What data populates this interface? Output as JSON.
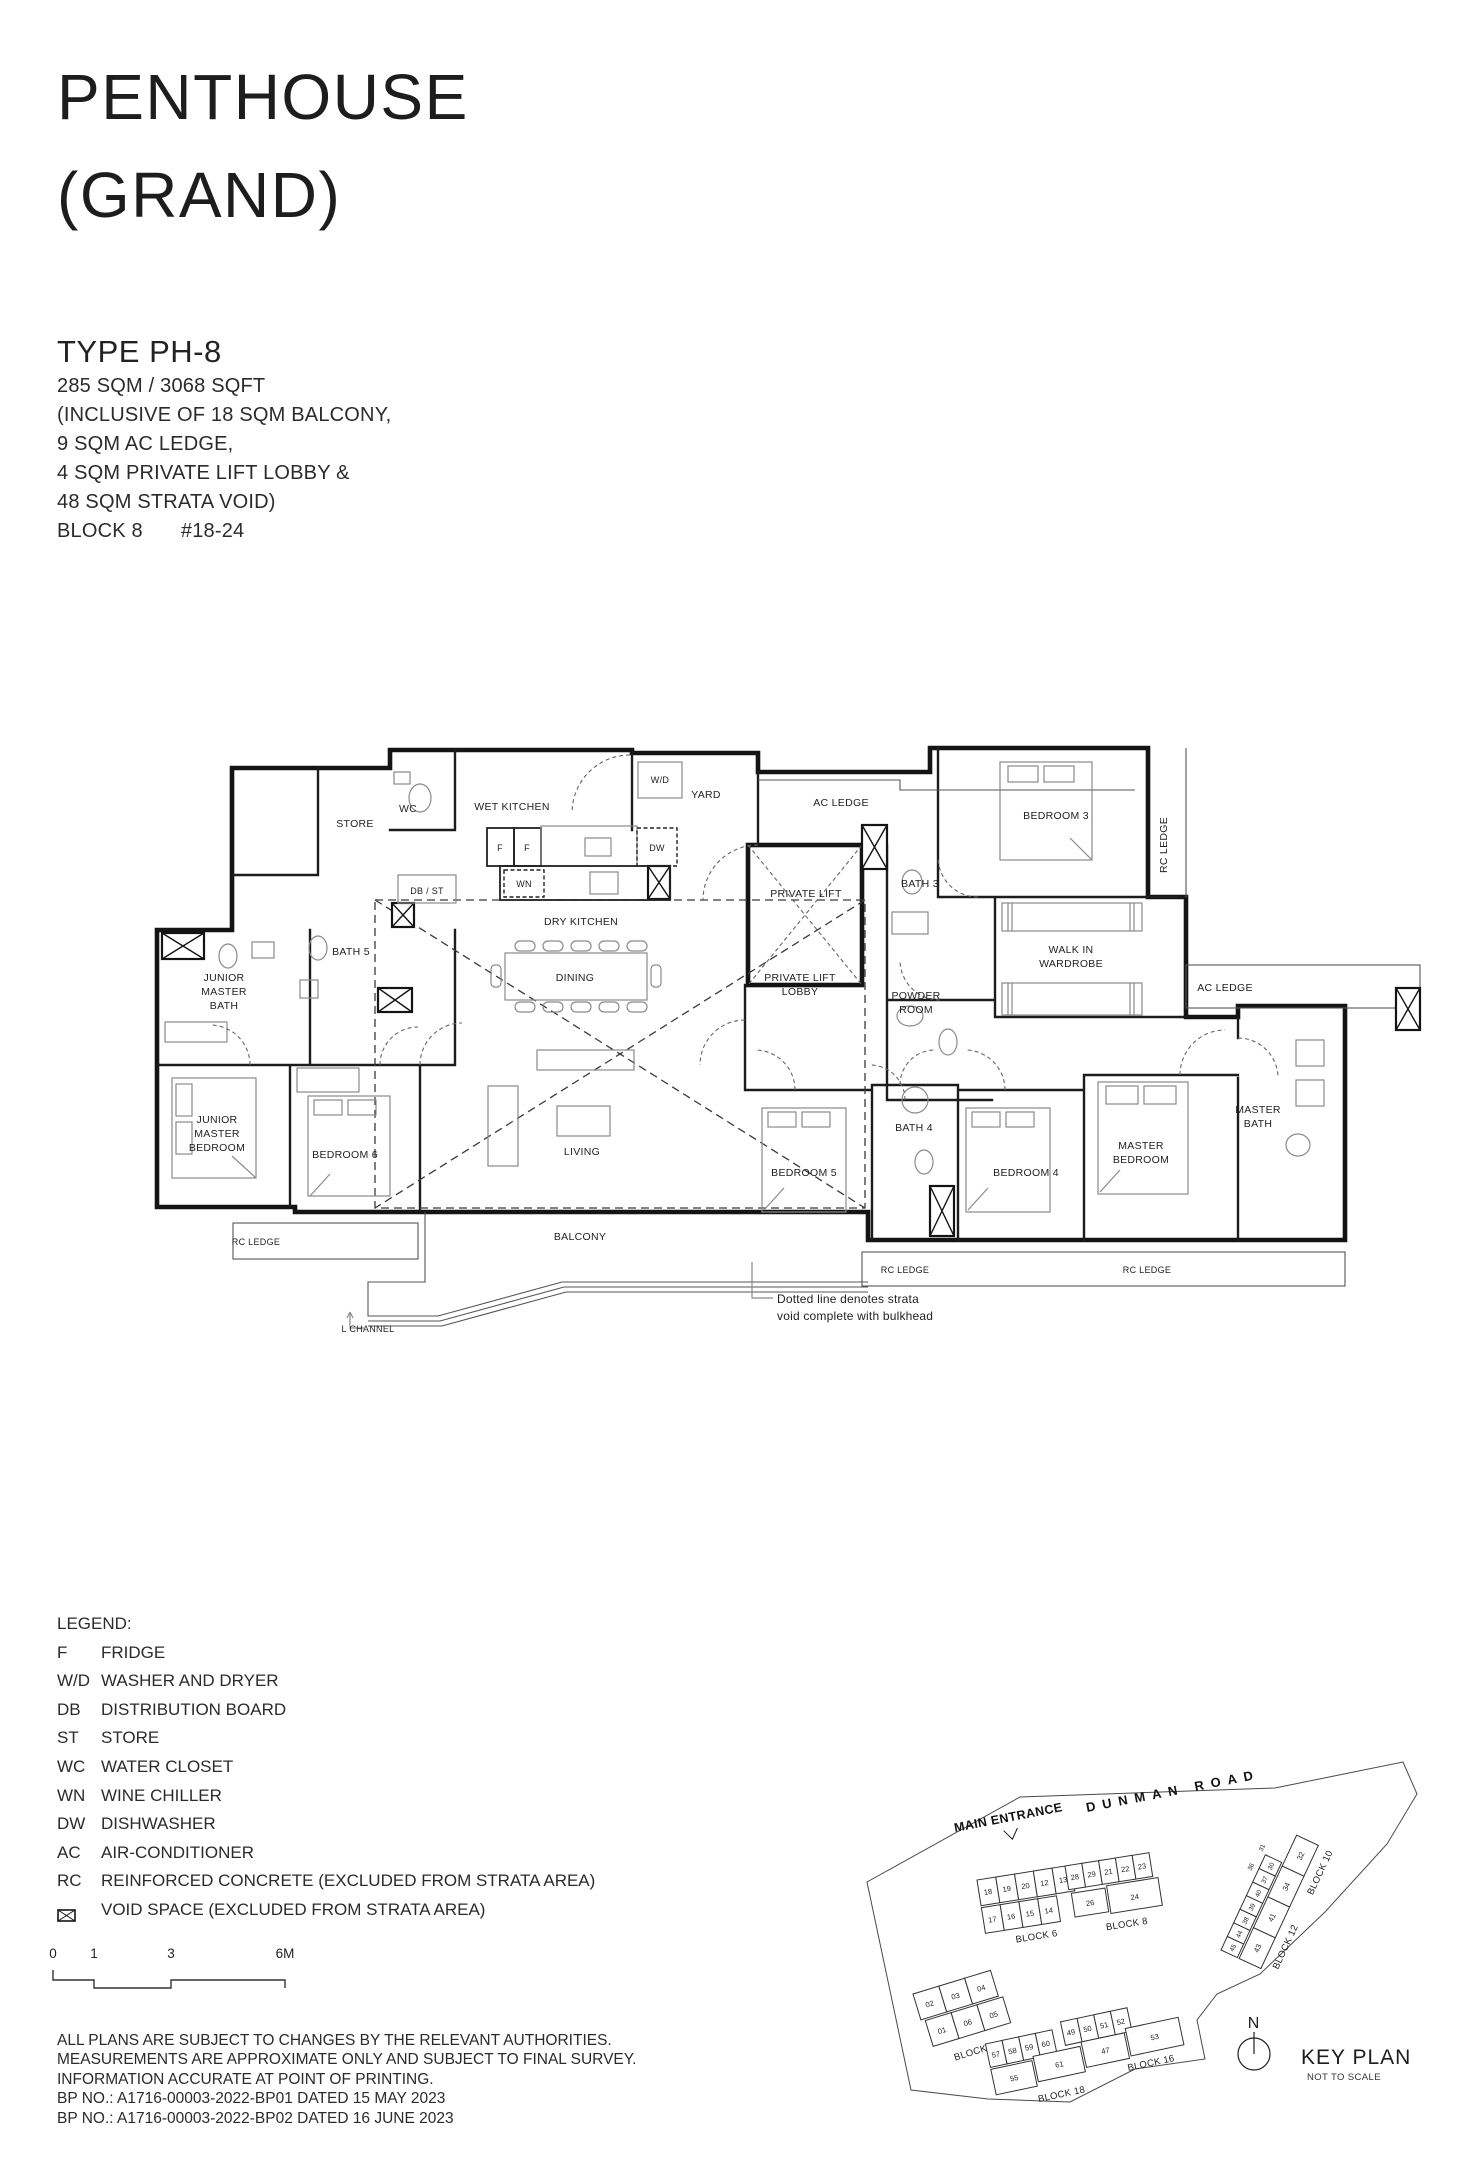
{
  "page": {
    "title_line1": "PENTHOUSE",
    "title_line2": "(GRAND)"
  },
  "unit_info": {
    "type_label": "TYPE PH-8",
    "area": "285 SQM / 3068 SQFT",
    "inclusions": [
      "(INCLUSIVE OF 18 SQM BALCONY,",
      "9 SQM AC LEDGE,",
      "4 SQM PRIVATE LIFT LOBBY &",
      "48 SQM STRATA VOID)"
    ],
    "block": "BLOCK 8",
    "unit": "#18-24"
  },
  "floor_plan": {
    "labels": [
      "STORE",
      "WC",
      "WET KITCHEN",
      "W/D",
      "YARD",
      "AC LEDGE",
      "BEDROOM 3",
      "RC LEDGE",
      "BATH 3",
      "WALK IN",
      "WARDROBE",
      "AC LEDGE",
      "DB / ST",
      "F",
      "F",
      "DW",
      "WN",
      "DRY KITCHEN",
      "PRIVATE LIFT",
      "PRIVATE LIFT",
      "LOBBY",
      "POWDER",
      "ROOM",
      "BATH 5",
      "JUNIOR",
      "MASTER",
      "BATH",
      "JUNIOR",
      "MASTER",
      "BEDROOM",
      "BEDROOM 6",
      "DINING",
      "LIVING",
      "BEDROOM 5",
      "BATH 4",
      "BEDROOM 4",
      "MASTER",
      "BEDROOM",
      "MASTER",
      "BATH",
      "BALCONY",
      "RC LEDGE",
      "RC LEDGE",
      "RC LEDGE",
      "L CHANNEL",
      "Dotted line denotes strata",
      "void complete with bulkhead"
    ]
  },
  "legend": {
    "heading": "LEGEND:",
    "items": [
      {
        "key": "F",
        "value": "FRIDGE"
      },
      {
        "key": "W/D",
        "value": "WASHER AND DRYER"
      },
      {
        "key": "DB",
        "value": "DISTRIBUTION BOARD"
      },
      {
        "key": "ST",
        "value": "STORE"
      },
      {
        "key": "WC",
        "value": "WATER CLOSET"
      },
      {
        "key": "WN",
        "value": "WINE CHILLER"
      },
      {
        "key": "DW",
        "value": "DISHWASHER"
      },
      {
        "key": "AC",
        "value": "AIR-CONDITIONER"
      },
      {
        "key": "RC",
        "value": "REINFORCED CONCRETE (EXCLUDED FROM STRATA AREA)"
      },
      {
        "key": "",
        "value": "VOID SPACE (EXCLUDED FROM STRATA AREA)",
        "icon": "void-space-icon"
      }
    ]
  },
  "scale_bar": {
    "ticks": [
      "0",
      "1",
      "3",
      "6M"
    ]
  },
  "disclaimer": [
    "ALL PLANS ARE SUBJECT TO CHANGES BY THE RELEVANT AUTHORITIES.",
    "MEASUREMENTS ARE APPROXIMATE ONLY AND SUBJECT TO FINAL SURVEY.",
    "INFORMATION ACCURATE AT POINT OF PRINTING.",
    "BP NO.: A1716-00003-2022-BP01 DATED 15 MAY 2023",
    "BP NO.: A1716-00003-2022-BP02 DATED 16 JUNE 2023"
  ],
  "key_plan": {
    "north": "N",
    "title": "KEY PLAN",
    "subtitle": "NOT TO SCALE",
    "main_entrance": "MAIN ENTRANCE",
    "road": "DUNMAN ROAD",
    "highlight_color": "#f3dfa3",
    "blocks": {
      "b6": {
        "label": "BLOCK 6",
        "row1": [
          "18",
          "19",
          "20",
          "12",
          "13"
        ],
        "row2": [
          "17",
          "16",
          "15",
          "14"
        ]
      },
      "b8": {
        "label": "BLOCK 8",
        "row1": [
          "28",
          "29",
          "21",
          "22",
          "23"
        ],
        "row2": [
          "26",
          "24"
        ]
      },
      "b10": {
        "label": "BLOCK 10",
        "units": [
          "31",
          "30",
          "37",
          "36",
          "34",
          "32"
        ]
      },
      "b12": {
        "label": "BLOCK 12",
        "units": [
          "40",
          "39",
          "38",
          "44",
          "45",
          "43",
          "41"
        ]
      },
      "b2": {
        "label": "BLOCK 2",
        "row1": [
          "02",
          "03",
          "04"
        ],
        "row2": [
          "01",
          "06",
          "05"
        ]
      },
      "b18": {
        "label": "BLOCK 18",
        "row1": [
          "57",
          "58",
          "59",
          "60"
        ],
        "row2": [
          "55",
          "61"
        ]
      },
      "b16": {
        "label": "BLOCK 16",
        "row1": [
          "49",
          "50",
          "51",
          "52"
        ],
        "row2": [
          "47",
          "53"
        ]
      }
    }
  }
}
